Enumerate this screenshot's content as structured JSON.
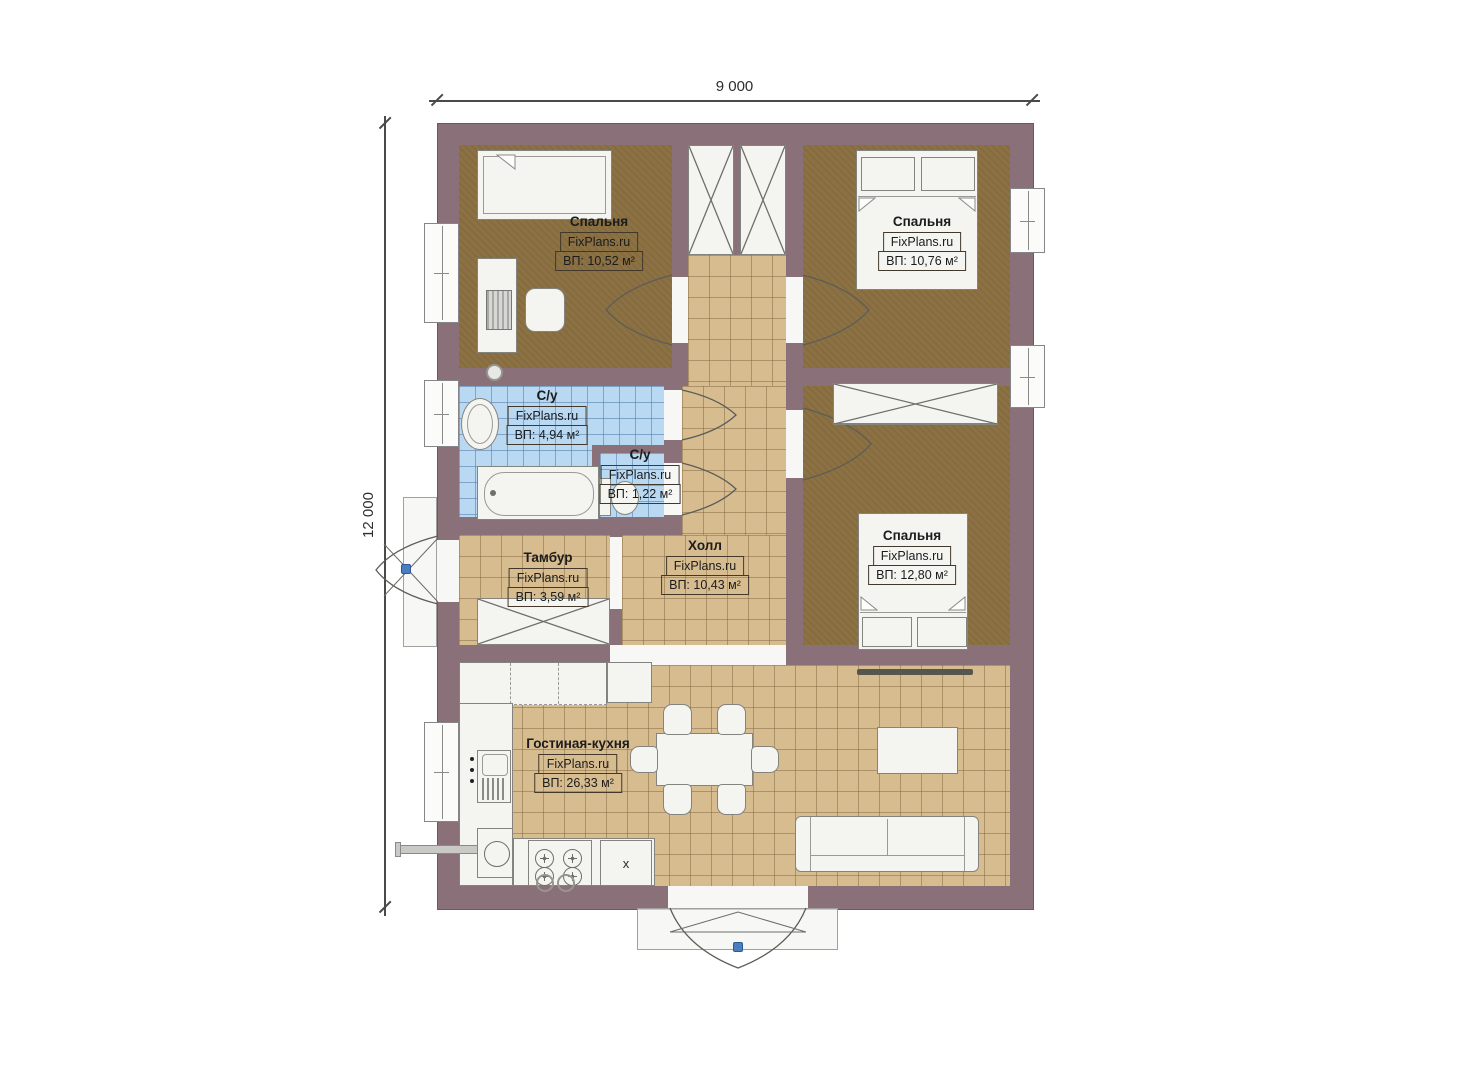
{
  "watermark": "FixPlans.ru",
  "dimensions": {
    "top": "9 000",
    "left": "12 000"
  },
  "rooms": [
    {
      "id": "bedroom-1",
      "name": "Спальня",
      "area": "ВП: 10,52 м²"
    },
    {
      "id": "bedroom-2",
      "name": "Спальня",
      "area": "ВП: 10,76 м²"
    },
    {
      "id": "bathroom",
      "name": "С/у",
      "area": "ВП: 4,94 м²"
    },
    {
      "id": "wc",
      "name": "С/у",
      "area": "ВП: 1,22 м²"
    },
    {
      "id": "vestibule",
      "name": "Тамбур",
      "area": "ВП: 3,59 м²"
    },
    {
      "id": "hall",
      "name": "Холл",
      "area": "ВП: 10,43 м²"
    },
    {
      "id": "bedroom-3",
      "name": "Спальня",
      "area": "ВП: 12,80 м²"
    },
    {
      "id": "living-kitchen",
      "name": "Гостиная-кухня",
      "area": "ВП: 26,33 м²"
    }
  ],
  "kitchen": {
    "appliance_marker": "х"
  },
  "colors": {
    "wall": "#8a7078",
    "carpet": "#8c7143",
    "tile": "#d7bc90",
    "wet_tile": "#b9d9f2",
    "door_point": "#4a7ec0"
  }
}
